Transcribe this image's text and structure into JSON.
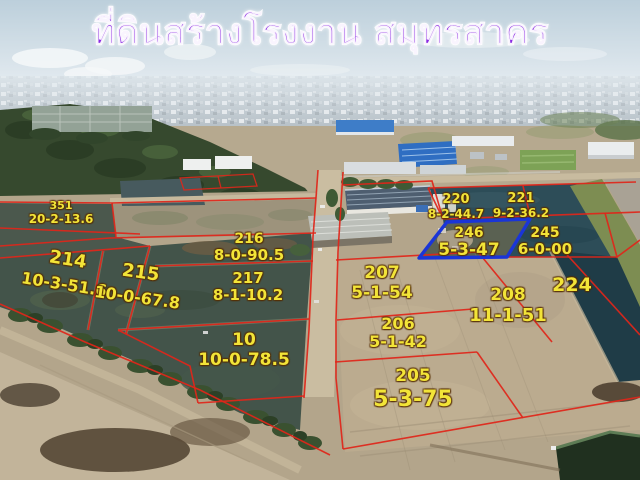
{
  "title": "ที่ดินสร้างโรงงาน สมุทรสาคร",
  "colors": {
    "title-color": "#8b2be2",
    "label-color": "#f2e438",
    "line-color": "#e0261a",
    "highlight-color": "#1a35d8"
  },
  "plots": [
    {
      "id": "351",
      "area": "20-2-13.6"
    },
    {
      "id": "214",
      "area": "10-3-51.6"
    },
    {
      "id": "215",
      "area": "10-0-67.8"
    },
    {
      "id": "216",
      "area": "8-0-90.5"
    },
    {
      "id": "217",
      "area": "8-1-10.2"
    },
    {
      "id": "10",
      "area": "10-0-78.5"
    },
    {
      "id": "220",
      "area": "8-2-44.7"
    },
    {
      "id": "221",
      "area": "9-2-36.2"
    },
    {
      "id": "246",
      "area": "5-3-47",
      "highlighted": true
    },
    {
      "id": "245",
      "area": "6-0-00"
    },
    {
      "id": "207",
      "area": "5-1-54"
    },
    {
      "id": "208",
      "area": "11-1-51"
    },
    {
      "id": "224"
    },
    {
      "id": "206",
      "area": "5-1-42"
    },
    {
      "id": "205",
      "area": "5-3-75"
    }
  ]
}
